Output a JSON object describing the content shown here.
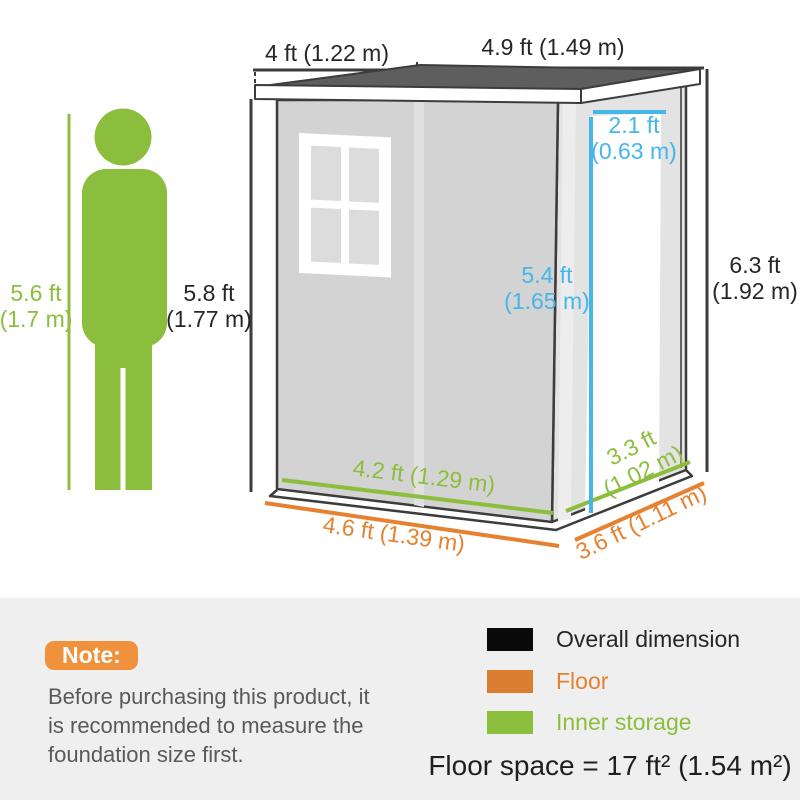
{
  "colors": {
    "accent_green": "#8CBE3E",
    "accent_orange": "#E5812F",
    "accent_blue": "#45B6E8",
    "dimension_black": "#262626",
    "note_badge_orange": "#F0923D",
    "note_text_gray": "#595959",
    "panel_background": "#F0EFEF",
    "roof_gray": "#5E5E5E",
    "front_wall_gray": "#D3D3D3",
    "side_wall_gray": "#E3E3E3"
  },
  "dims": {
    "roof_depth": "4 ft (1.22 m)",
    "roof_width": "4.9 ft (1.49 m)",
    "person_height": {
      "ft": "5.6 ft",
      "m": "(1.7 m)"
    },
    "front_height": {
      "ft": "5.8 ft",
      "m": "(1.77 m)"
    },
    "rear_height": {
      "ft": "6.3 ft",
      "m": "(1.92 m)"
    },
    "door_width": {
      "ft": "2.1 ft",
      "m": "(0.63 m)"
    },
    "door_height": {
      "ft": "5.4 ft",
      "m": "(1.65 m)"
    },
    "inner_width": "4.2 ft (1.29 m)",
    "floor_width": "4.6 ft (1.39 m)",
    "inner_depth": {
      "ft": "3.3 ft",
      "m": "(1.02 m)"
    },
    "floor_depth": "3.6 ft (1.11 m)"
  },
  "note": {
    "badge": "Note:",
    "lines": [
      "Before purchasing this product, it",
      "is recommended to measure the",
      "foundation size first."
    ]
  },
  "legend": {
    "items": [
      {
        "label": "Overall dimension",
        "color": "#0A0A0A"
      },
      {
        "label": "Floor",
        "color": "#DC7E2F"
      },
      {
        "label": "Inner storage",
        "color": "#8CBE3E"
      }
    ]
  },
  "floor_space": "Floor space = 17 ft² (1.54 m²)"
}
